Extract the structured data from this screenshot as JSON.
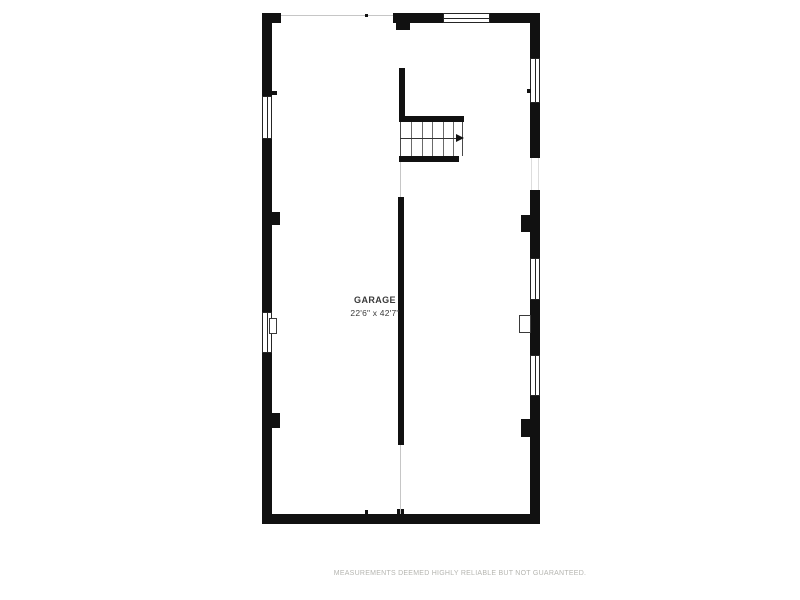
{
  "floorplan": {
    "room_label": "GARAGE",
    "room_dimensions": "22'6\" x 42'7\"",
    "features": {
      "staircase": "L-shaped stair, top center, arrow pointing right",
      "windows": [
        "top wall",
        "left wall upper",
        "left wall lower",
        "right wall upper",
        "right wall middle",
        "right wall lower"
      ],
      "openings": [
        "top wall garage-door opening",
        "right wall doorway",
        "interior wall openings"
      ]
    }
  },
  "footer": {
    "disclaimer": "MEASUREMENTS DEEMED HIGHLY RELIABLE BUT NOT GUARANTEED."
  },
  "colors": {
    "wall": "#111111",
    "background": "#ffffff",
    "label_text": "#3a3a3a",
    "disclaimer_text": "#b5b5b0",
    "thin_line": "#c6c6c6"
  }
}
